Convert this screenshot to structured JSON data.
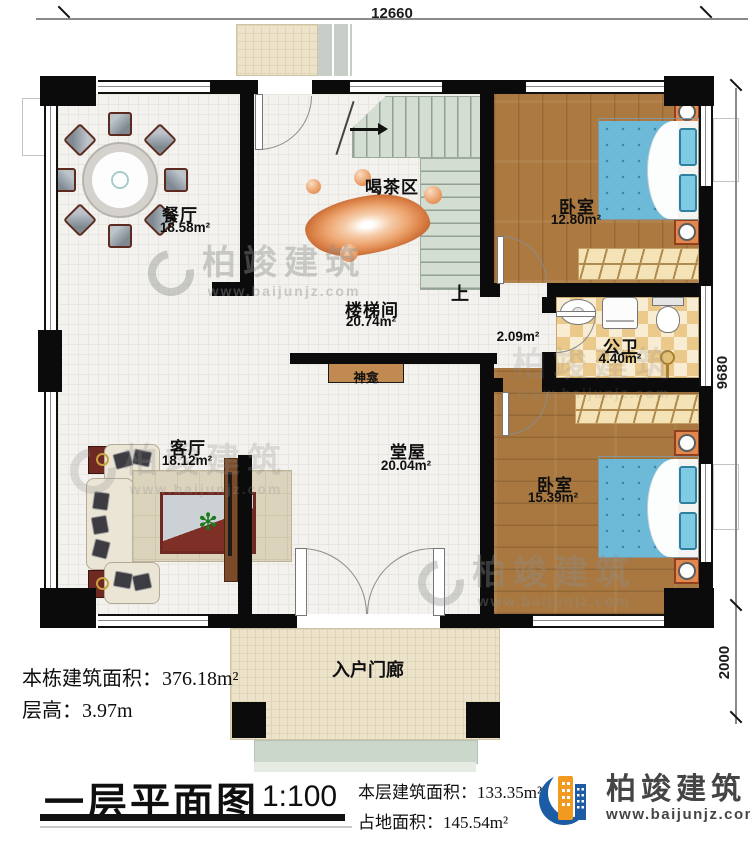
{
  "plan": {
    "dimensions": {
      "width_top": "12660",
      "height_right": "9680",
      "porch_depth": "2000"
    },
    "rooms": {
      "dining": {
        "name": "餐厅",
        "area": "18.58m²"
      },
      "tea_area": {
        "name": "喝茶区"
      },
      "stair_hall": {
        "name": "楼梯间",
        "area": "20.74m²"
      },
      "stairs_up": {
        "label": "上"
      },
      "bedroom1": {
        "name": "卧室",
        "area": "12.80m²"
      },
      "corridor": {
        "area": "2.09m²"
      },
      "bathroom": {
        "name": "公卫",
        "area": "4.40m²"
      },
      "bedroom2": {
        "name": "卧室",
        "area": "15.39m²"
      },
      "living": {
        "name": "客厅",
        "area": "18.12m²"
      },
      "hall": {
        "name": "堂屋",
        "area": "20.04m²"
      },
      "shrine": {
        "name": "神龛"
      },
      "entry_porch": {
        "name": "入户门廊"
      }
    }
  },
  "info": {
    "total_area_label": "本栋建筑面积：",
    "total_area_value": "376.18m²",
    "floor_height_label": "层高：",
    "floor_height_value": "3.97m"
  },
  "title_block": {
    "title": "一层平面图",
    "scale": "1:100",
    "floor_area_label": "本层建筑面积：",
    "floor_area_value": "133.35m²",
    "footprint_label": "占地面积：",
    "footprint_value": "145.54m²"
  },
  "brand": {
    "name": "柏竣建筑",
    "website": "www.baijunjz.com"
  },
  "watermark": {
    "text": "柏竣建筑",
    "website": "www.baijunjz.com"
  },
  "colors": {
    "wall": "#0b0b0b",
    "wood_floor": "#ac7a41",
    "bath_tile": "#ebc98b",
    "stair": "#d3ddd2",
    "accent_orange": "#e08b52",
    "brand_blue": "#1b5ca5",
    "brand_orange": "#f29a1f"
  }
}
